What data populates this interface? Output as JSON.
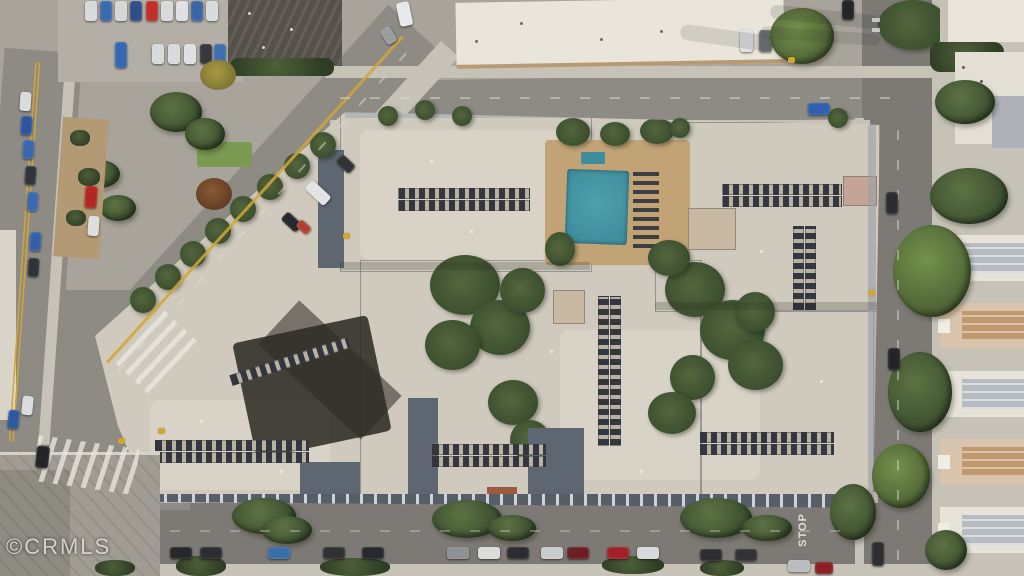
{
  "watermark": {
    "text": "©CRMLS"
  },
  "road_markings": {
    "stop_text": "STOP"
  },
  "palette": {
    "asphalt": "#8e8b85",
    "asphalt_dark": "#7d7a75",
    "concrete": "#a8a49b",
    "sidewalk": "#c6c2b7",
    "roof": "#cfcabd",
    "roof_light": "#ddd8cb",
    "slate": "#5e6672",
    "facade": "#575e68",
    "deck": "#c2a376",
    "pool": "#4f9fad",
    "pool_deep": "#3f8d9c",
    "green_dark": "#3d5130",
    "green_mid": "#5d7243",
    "green_bright": "#74914c",
    "dirt": "#b39a74",
    "yellow": "#d2a634",
    "line_white": "#dedbd2",
    "townhouse": "#e7e3d8",
    "town_roof": "#b7bcc2",
    "dark_roof": "#55514a",
    "grass": "#7a9a52"
  },
  "scene_elements": {
    "pool": "swimming-pool",
    "complex": "apartment-complex-roof",
    "streets": [
      "left-street",
      "diagonal-street",
      "top-street",
      "right-street",
      "bottom-street"
    ]
  }
}
